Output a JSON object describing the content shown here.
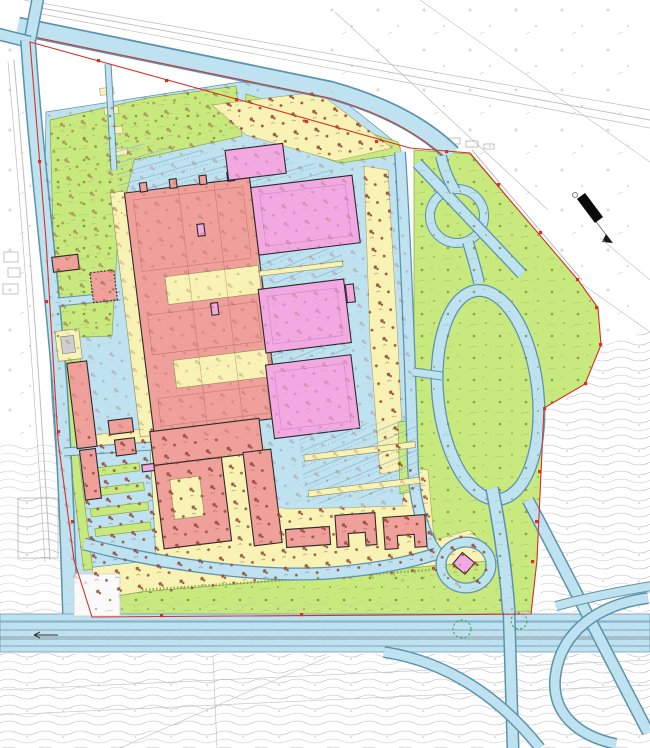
{
  "document": {
    "kind": "architectural-site-master-plan",
    "visible_text": [],
    "orientation_note": "site block rotated slightly counter-clockwise; north arrow points to lower-right"
  },
  "palette": {
    "paving": "#bfe2f1",
    "paving-edge": "#5b93ad",
    "greenery": "#c8e97e",
    "greenery-edge": "#84a847",
    "yellow": "#f8f3b5",
    "yellow-edge": "#a8a06a",
    "bred": "#f0a09a",
    "bmag": "#f2a9e2",
    "ink": "#2b2b2b",
    "boundary": "#d93025",
    "terrain": "#b5b5b5",
    "tree-brown": "#94452f",
    "tree-olive": "#6f8f33",
    "paper": "#ffffff"
  },
  "zones": [
    {
      "id": "paving",
      "name": "roads-and-paved-areas",
      "color_ref": "paving"
    },
    {
      "id": "greenery",
      "name": "lawns-and-planting",
      "color_ref": "greenery"
    },
    {
      "id": "yellow",
      "name": "pedestrian-landscape-areas-with-trees",
      "color_ref": "yellow"
    },
    {
      "id": "bred",
      "name": "buildings-type-a-salmon",
      "color_ref": "bred"
    },
    {
      "id": "bmag",
      "name": "buildings-type-b-magenta",
      "color_ref": "bmag"
    },
    {
      "id": "boundary",
      "name": "site-boundary-line",
      "color_ref": "boundary"
    },
    {
      "id": "terrain",
      "name": "existing-terrain-contours",
      "color_ref": "terrain"
    }
  ],
  "features": [
    "north-access-road-diagonal",
    "west-perimeter-road",
    "small-roundabout-circle",
    "large-loop-road-east",
    "cul-de-sac-with-small-building",
    "south-highway-dual-carriageway",
    "highway-interchange-ramps",
    "north-parking-lot",
    "east-parking-rows",
    "southwest-parking-with-green-islands",
    "red-building-complex-with-yellow-courtyards",
    "magenta-building-blocks",
    "u-shaped-south-buildings",
    "north-arrow"
  ],
  "north_arrow": {
    "direction": "lower-right"
  }
}
